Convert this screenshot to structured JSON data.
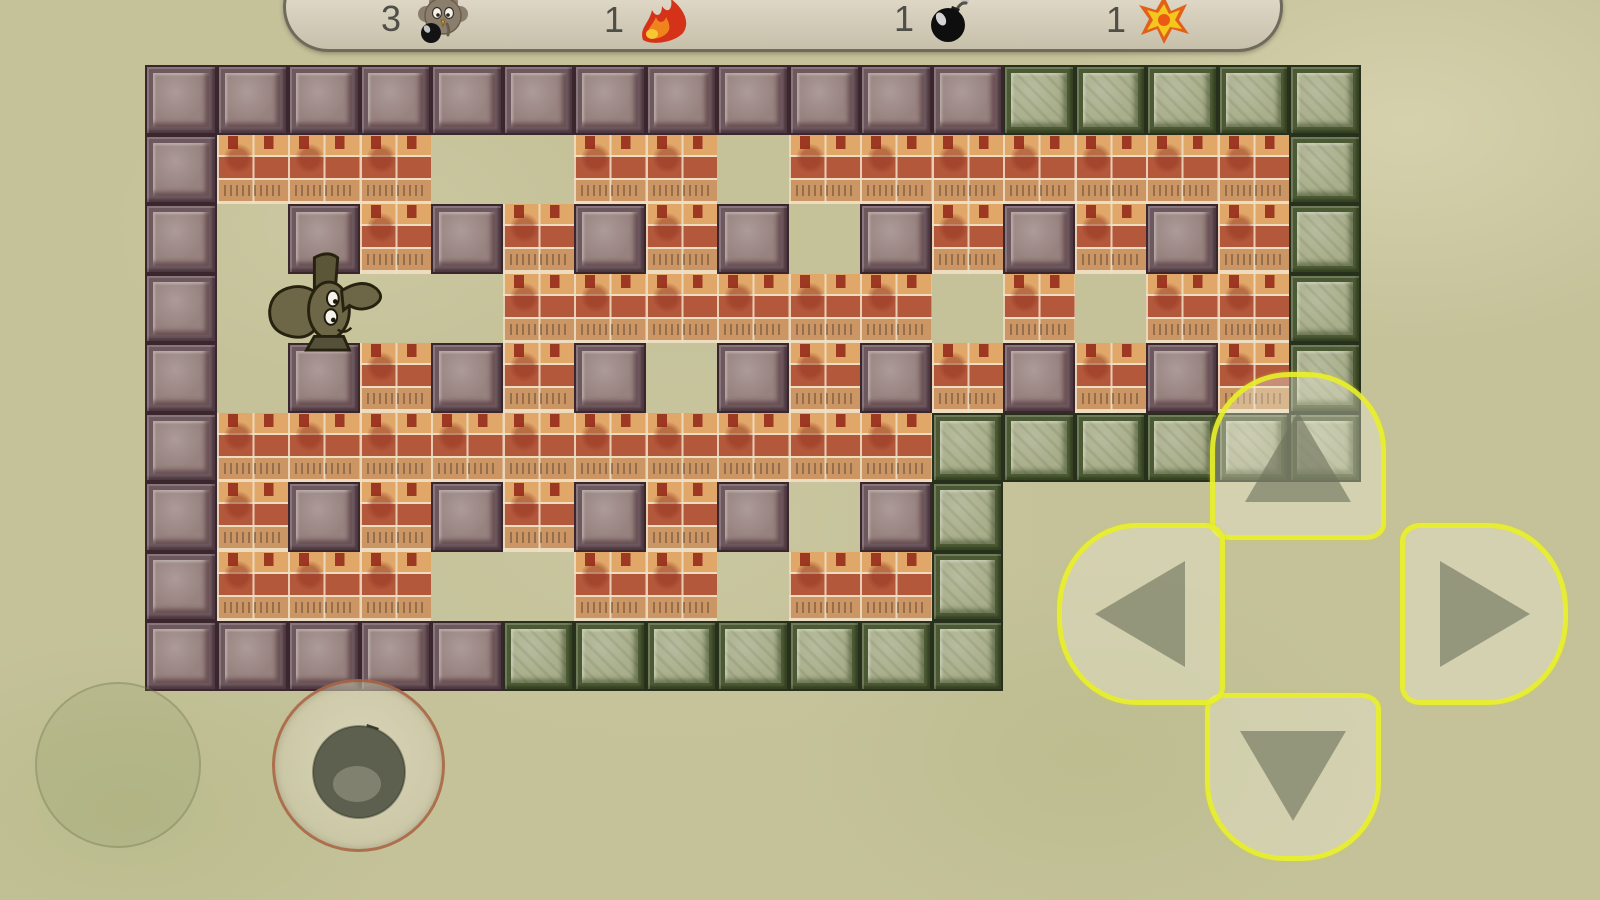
{
  "hud": {
    "items": [
      {
        "count": "3",
        "icon": "elephant-lives-icon",
        "meaning": "lives"
      },
      {
        "count": "1",
        "icon": "flame-icon",
        "meaning": "flame power"
      },
      {
        "count": "1",
        "icon": "bomb-icon",
        "meaning": "bombs"
      },
      {
        "count": "1",
        "icon": "explosion-icon",
        "meaning": "blast power"
      }
    ]
  },
  "board": {
    "legend": {
      "S": "stone-border-block",
      "P": "stone-pillar-block",
      "G": "green-stone-block",
      "B": "brick-block",
      ".": "floor",
      " ": "outside"
    },
    "rows": [
      "SSSSSSSSSSSSGGGGG",
      "SBBB..BB.BBBBBBBG",
      "S.PBPBPBP.PBPBPBG",
      "S....BBBBBB.B.BBG",
      "S.PBPBP.PBPBPBPBG",
      "SBBBBBBBBBBGGGGGG",
      "SBPBPBPBP.PG     ",
      "SBBB..BB.BBG     ",
      "SSSSSGGGGGGG     "
    ],
    "player": {
      "sprite": "elephant",
      "col": 2,
      "row": 3
    }
  },
  "controls": {
    "dpad": [
      "up",
      "right",
      "down",
      "left"
    ],
    "bomb_button": "bomb",
    "inactive_button": ""
  },
  "colors": {
    "background": "#c5c29a",
    "stone_fill": "#97827f",
    "stone_frame": "#3c262d",
    "green_fill": "#a9ae8b",
    "green_frame": "#26301a",
    "brick_orange": "#e0a768",
    "brick_red": "#b4583c",
    "mortar": "#eddcbf",
    "dpad_outline": "#e8ee26",
    "bomb_button_outline": "#a35736",
    "hud_fill": "#d9d2bf"
  }
}
